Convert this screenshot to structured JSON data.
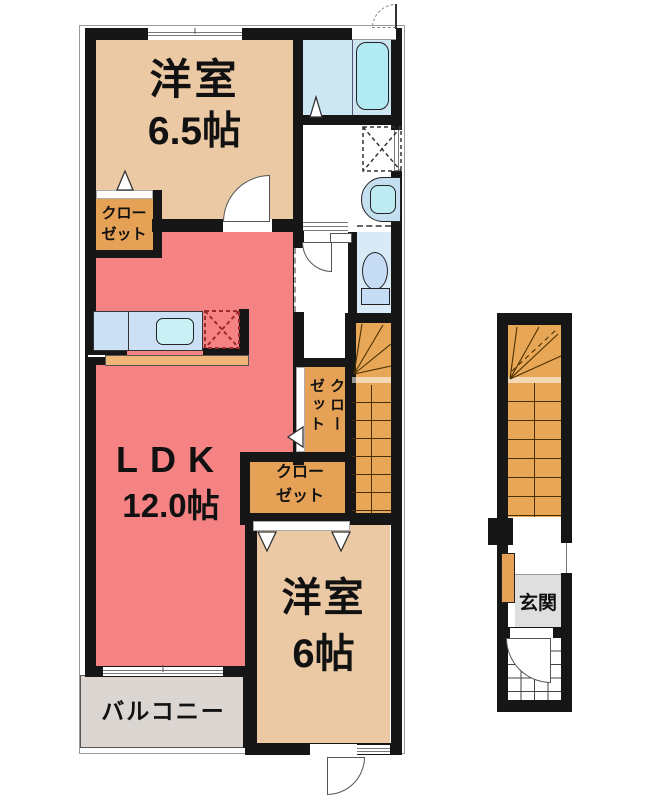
{
  "plan_title": "apartment-floor-plan",
  "rooms": {
    "western_room_upper": {
      "name": "洋室",
      "size": "6.5帖"
    },
    "ldk": {
      "name": "LDK",
      "size": "12.0帖"
    },
    "western_room_lower": {
      "name": "洋室",
      "size": "6帖"
    },
    "balcony": {
      "name": "バルコニー"
    },
    "entrance": {
      "name": "玄関"
    },
    "closet_upper_left": {
      "line1": "クロー",
      "line2": "ゼット"
    },
    "closet_middle_vertical": {
      "text": "クローゼット"
    },
    "closet_lower": {
      "line1": "クロー",
      "line2": "ゼット"
    }
  },
  "colors": {
    "wall": "#161616",
    "room_beige": "#EBC9A4",
    "closet_orange": "#E5A155",
    "stairs_orange": "#E7A757",
    "ldk_salmon": "#F58383",
    "bath_blue": "#CCE6F2",
    "tub_cyan": "#B2EAF3",
    "toilet_blue": "#D9EAF7",
    "fixture_blue": "#C6DCF5",
    "counter_blue": "#CBDFF5",
    "kitchen_step_orange": "#EFB678",
    "balcony_gray": "#DBD6D2",
    "entrance_gray": "#DFDFDF",
    "fridge_dashed_red": "#9E2B2B"
  }
}
